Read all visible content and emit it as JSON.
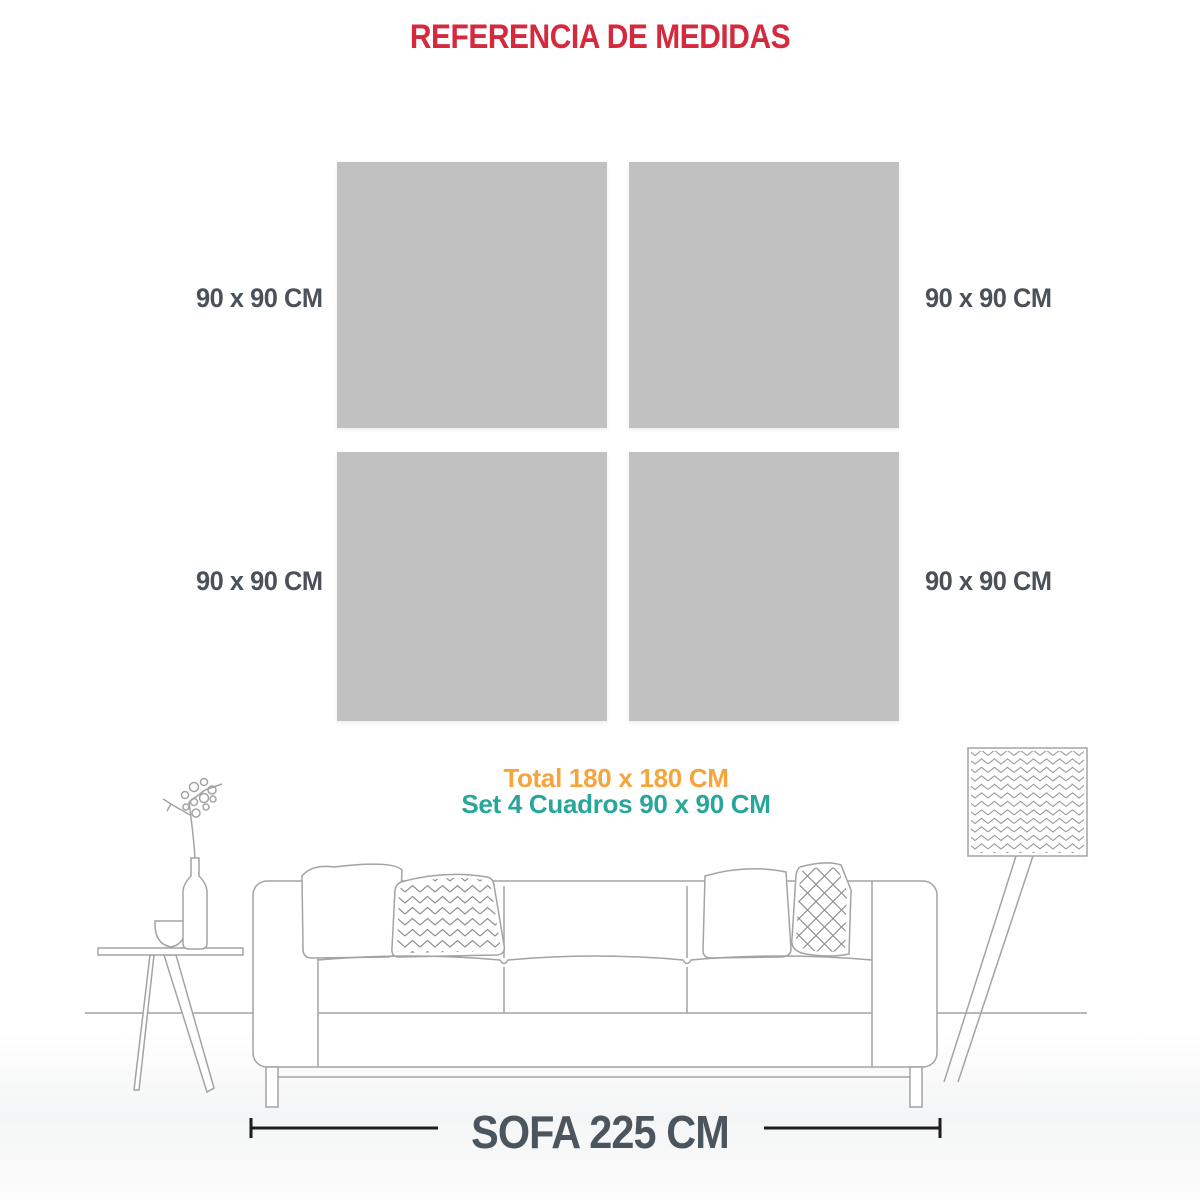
{
  "page": {
    "title": "REFERENCIA DE MEDIDAS"
  },
  "colors": {
    "title_red": "#d5293d",
    "frame_gray": "#c1c1c1",
    "label_gray": "#4a5158",
    "total_orange": "#f5a53c",
    "set_teal": "#29a69c",
    "sofa_text": "#4b555e",
    "line_art": "#a3a3a3",
    "dimension_line": "#1c1c1c"
  },
  "frames": {
    "items": [
      {
        "id": "top-left",
        "label": "90 x 90 CM"
      },
      {
        "id": "top-right",
        "label": "90 x 90 CM"
      },
      {
        "id": "bottom-left",
        "label": "90 x 90 CM"
      },
      {
        "id": "bottom-right",
        "label": "90 x 90 CM"
      }
    ]
  },
  "summary": {
    "total_label": "Total 180 x 180 CM",
    "set_label": "Set 4 Cuadros 90 x 90 CM"
  },
  "sofa": {
    "dimension_label": "SOFA 225 CM",
    "illustration_elements": [
      "side-table",
      "vase",
      "branch",
      "bowl",
      "sofa-outline",
      "plain-pillow-left",
      "chevron-pillow",
      "plain-pillow-right",
      "diamond-pillow",
      "floor-lamp"
    ]
  }
}
